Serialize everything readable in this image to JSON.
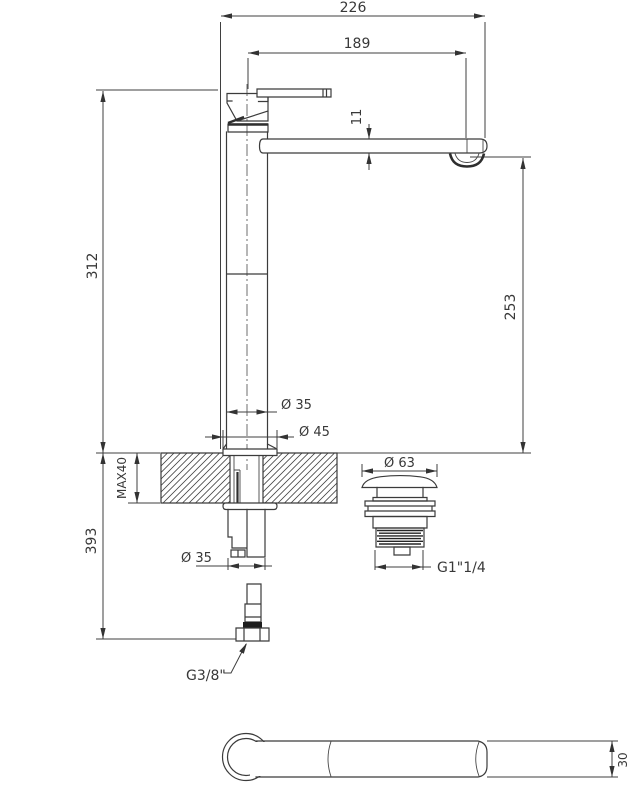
{
  "drawing": {
    "title": "basin-mixer-technical-drawing",
    "background": "#ffffff",
    "line_color": "#3b3b3b",
    "dimensions": {
      "overall_width": "226",
      "spout_reach": "189",
      "spout_thickness": "11",
      "height_above_deck": "312",
      "spout_height_above_deck": "253",
      "body_diameter": "Ø 35",
      "base_diameter": "Ø 45",
      "deck_max_thickness": "MAX40",
      "below_deck_length": "393",
      "shank_diameter": "Ø 35",
      "waste_cap_diameter": "Ø 63",
      "waste_thread": "G1\"1/4",
      "supply_thread": "G3/8\"",
      "spout_width": "30"
    }
  }
}
